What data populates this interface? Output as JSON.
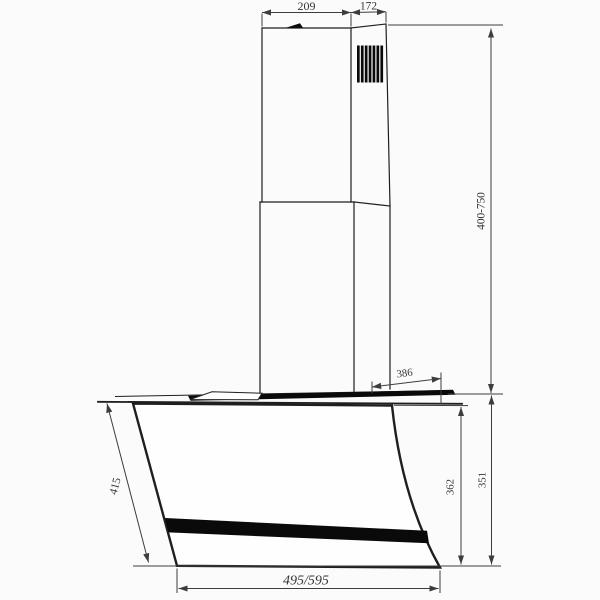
{
  "drawing": {
    "title": "Wall-mounted cooker hood dimension drawing",
    "dims": {
      "chimney_width": "209",
      "chimney_depth": "172",
      "chimney_height_range": "400-750",
      "top_depth": "386",
      "glass_front_length": "415",
      "front_height": "362",
      "body_height": "351",
      "overall_width": "495/595"
    },
    "colors": {
      "line": "#1f1f1f",
      "dim_line": "#3d3d3d",
      "text": "#343434",
      "accent_fill": "#0a0a0a",
      "panel_fill": "#fefefe",
      "background": "#fbfbfb"
    }
  }
}
